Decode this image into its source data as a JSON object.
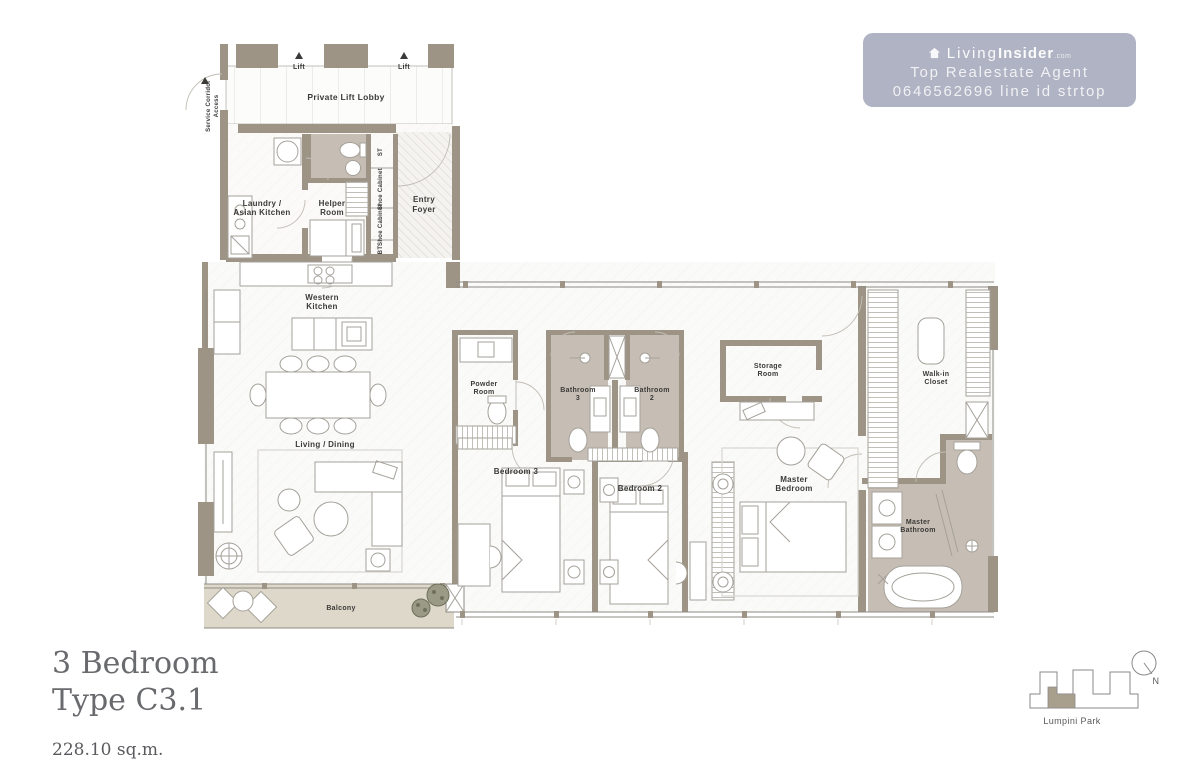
{
  "watermark": {
    "brand_prefix": "Living",
    "brand_bold": "Insider",
    "brand_suffix": ".com",
    "line2": "Top Realestate Agent",
    "line3": "0646562696 line id strtop"
  },
  "title": {
    "line1": "3 Bedroom",
    "line2": "Type C3.1",
    "area": "228.10 sq.m."
  },
  "key_plan": {
    "park_label": "Lumpini Park",
    "north_label": "N"
  },
  "plan": {
    "labels": {
      "service_corridor_1": "Service Corridor",
      "service_corridor_2": "Access",
      "lift": "Lift",
      "private_lift_lobby": "Private Lift Lobby",
      "laundry_1": "Laundry /",
      "laundry_2": "Asian Kitchen",
      "helper_1": "Helper",
      "helper_2": "Room",
      "st": "ST",
      "shoe_cabinet": "Shoe Cabinet",
      "bt": "BT",
      "entry_1": "Entry",
      "entry_2": "Foyer",
      "western_1": "Western",
      "western_2": "Kitchen",
      "living_dining": "Living / Dining",
      "balcony": "Balcony",
      "powder_1": "Powder",
      "powder_2": "Room",
      "bathroom3_1": "Bathroom",
      "bathroom3_2": "3",
      "bathroom2_1": "Bathroom",
      "bathroom2_2": "2",
      "bedroom3": "Bedroom 3",
      "bedroom2": "Bedroom 2",
      "storage_1": "Storage",
      "storage_2": "Room",
      "master_bedroom_1": "Master",
      "master_bedroom_2": "Bedroom",
      "walk_in_1": "Walk-in",
      "walk_in_2": "Closet",
      "master_bathroom_1": "Master",
      "master_bathroom_2": "Bathroom"
    }
  },
  "colors": {
    "wall": "#9d9486",
    "bathroom_floor": "#c6beb4",
    "balcony_floor": "#ddd8c9",
    "watermark_bg": "#a8acbe",
    "title_text": "#696a6d",
    "label_text": "#3b3a38",
    "unit_highlight": "#a89f8c"
  }
}
